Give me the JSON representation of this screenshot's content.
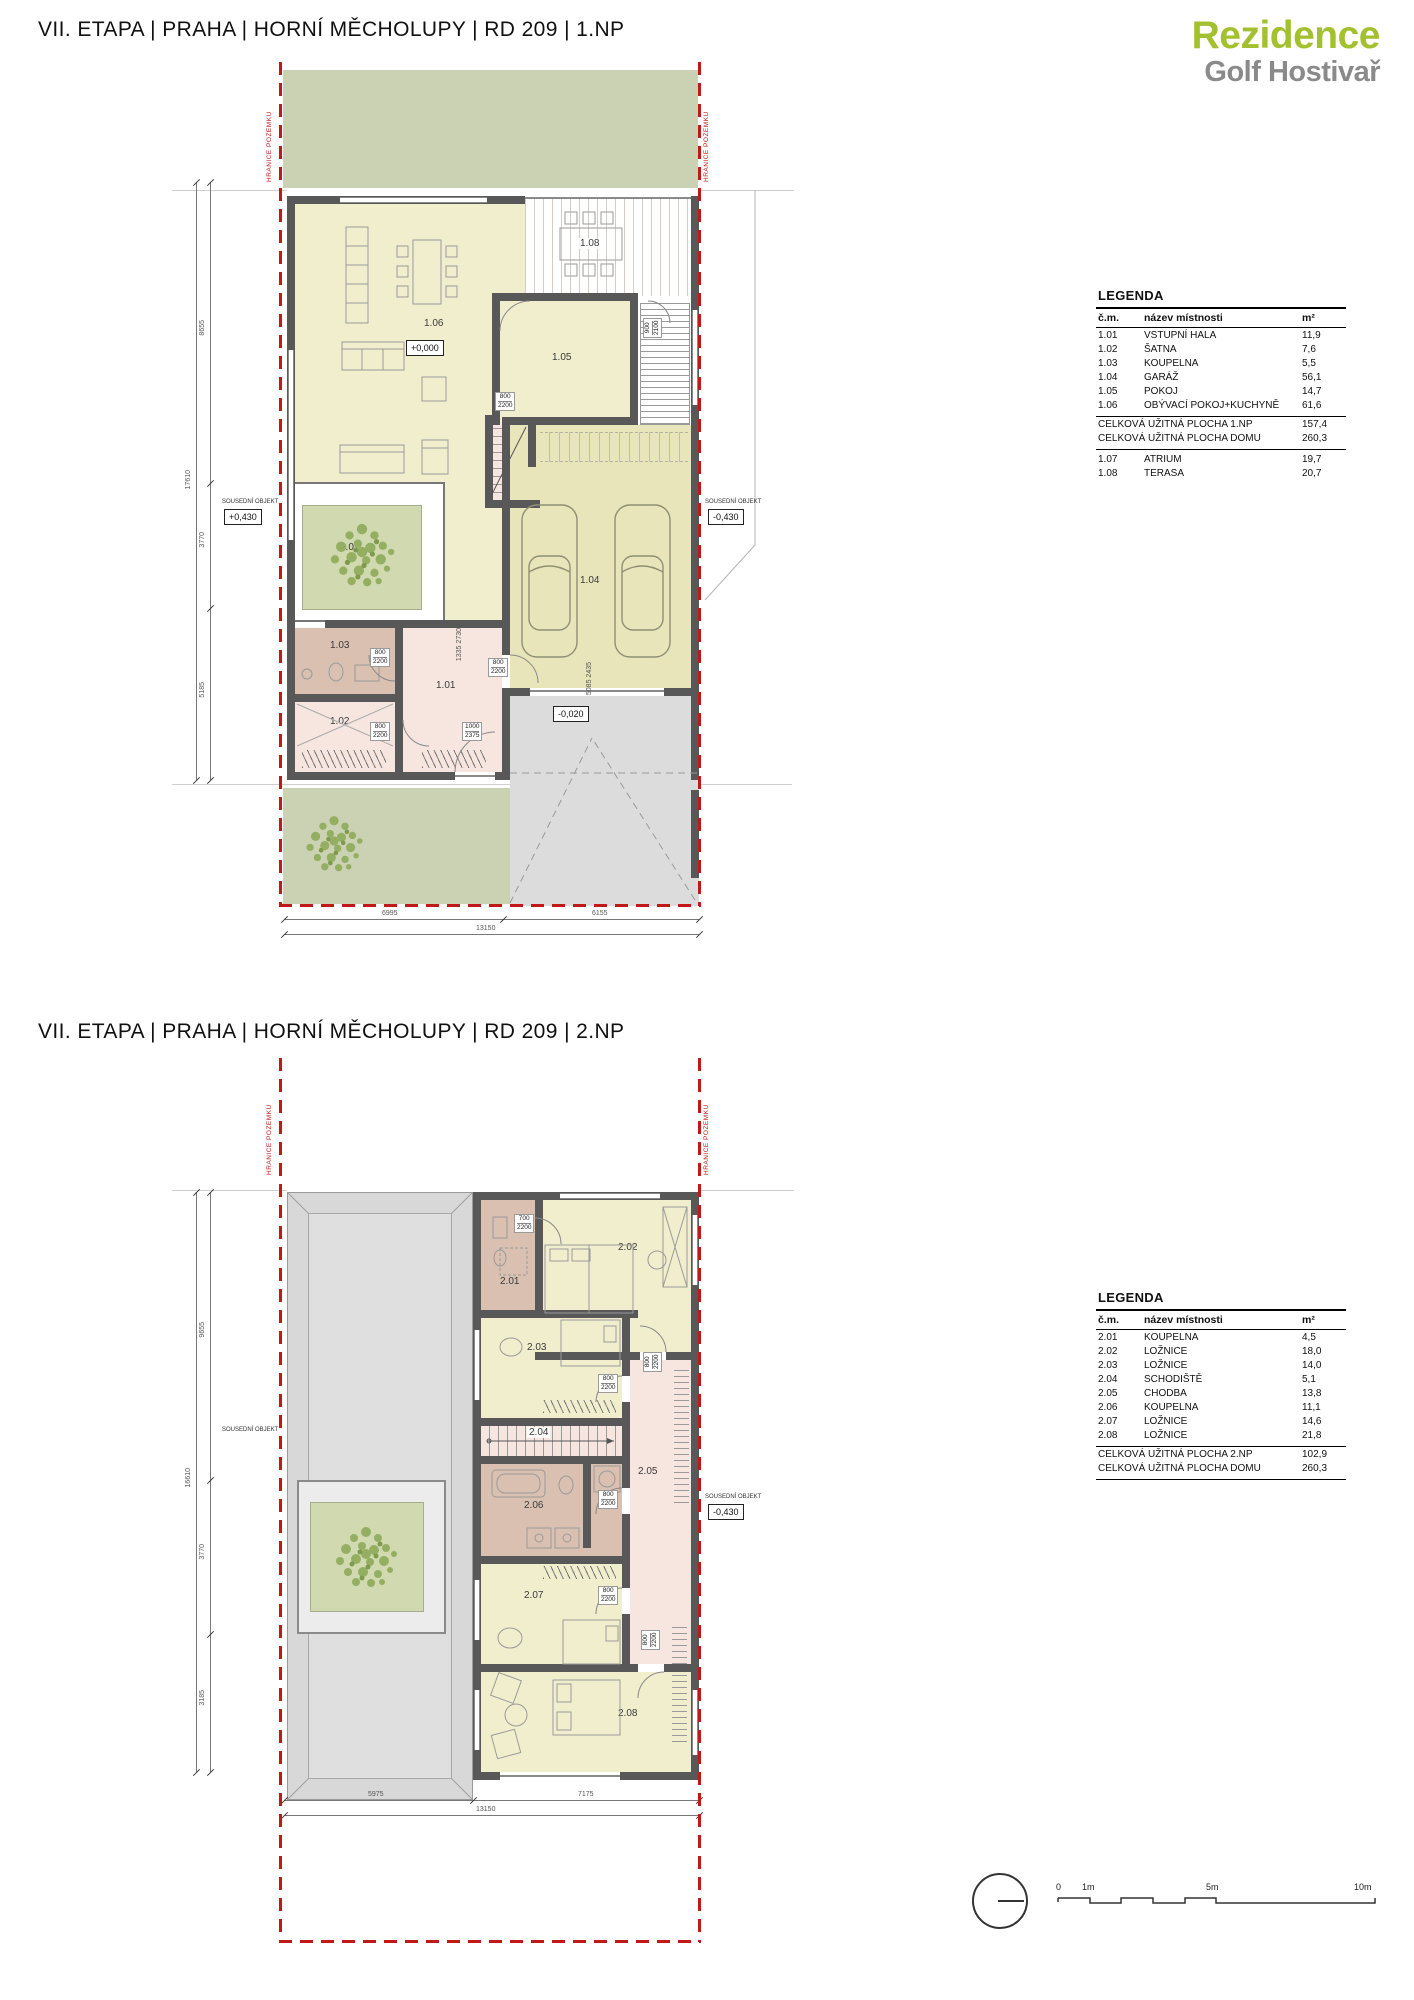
{
  "titles": {
    "plan1": "VII. ETAPA  |  PRAHA  | HORNÍ MĚCHOLUPY | RD 209  |  1.NP",
    "plan2": "VII. ETAPA  |  PRAHA  | HORNÍ MĚCHOLUPY | RD 209  |  2.NP"
  },
  "logo": {
    "line1": "Rezidence",
    "line2": "Golf Hostivař",
    "green": "#a3c12e",
    "gray": "#8a8a8a"
  },
  "legend1": {
    "heading": "LEGENDA",
    "col_num": "č.m.",
    "col_name": "název místnosti",
    "col_area": "m²",
    "rows": [
      {
        "num": "1.01",
        "name": "VSTUPNÍ HALA",
        "area": "11,9"
      },
      {
        "num": "1.02",
        "name": "ŠATNA",
        "area": "7,6"
      },
      {
        "num": "1.03",
        "name": "KOUPELNA",
        "area": "5,5"
      },
      {
        "num": "1.04",
        "name": "GARÁŽ",
        "area": "56,1"
      },
      {
        "num": "1.05",
        "name": "POKOJ",
        "area": "14,7"
      },
      {
        "num": "1.06",
        "name": "OBÝVACÍ POKOJ+KUCHYNĚ",
        "area": "61,6"
      }
    ],
    "totals": [
      {
        "name": "CELKOVÁ UŽITNÁ PLOCHA 1.NP",
        "area": "157,4"
      },
      {
        "name": "CELKOVÁ UŽITNÁ PLOCHA DOMU",
        "area": "260,3"
      }
    ],
    "extra": [
      {
        "num": "1.07",
        "name": "ATRIUM",
        "area": "19,7"
      },
      {
        "num": "1.08",
        "name": "TERASA",
        "area": "20,7"
      }
    ]
  },
  "legend2": {
    "heading": "LEGENDA",
    "col_num": "č.m.",
    "col_name": "název místnosti",
    "col_area": "m²",
    "rows": [
      {
        "num": "2.01",
        "name": "KOUPELNA",
        "area": "4,5"
      },
      {
        "num": "2.02",
        "name": "LOŽNICE",
        "area": "18,0"
      },
      {
        "num": "2.03",
        "name": "LOŽNICE",
        "area": "14,0"
      },
      {
        "num": "2.04",
        "name": "SCHODIŠTĚ",
        "area": "5,1"
      },
      {
        "num": "2.05",
        "name": "CHODBA",
        "area": "13,8"
      },
      {
        "num": "2.06",
        "name": "KOUPELNA",
        "area": "11,1"
      },
      {
        "num": "2.07",
        "name": "LOŽNICE",
        "area": "14,6"
      },
      {
        "num": "2.08",
        "name": "LOŽNICE",
        "area": "21,8"
      }
    ],
    "totals": [
      {
        "name": "CELKOVÁ UŽITNÁ PLOCHA 2.NP",
        "area": "102,9"
      },
      {
        "name": "CELKOVÁ UŽITNÁ PLOCHA DOMU",
        "area": "260,3"
      }
    ]
  },
  "plan1": {
    "boundary_label": "HRANICE POZEMKU",
    "neighbor_label": "SOUSEDNÍ OBJEKT",
    "rooms": {
      "r101": "1.01",
      "r102": "1.02",
      "r103": "1.03",
      "r104": "1.04",
      "r105": "1.05",
      "r106": "1.06",
      "r107": "1.07",
      "r108": "1.08"
    },
    "levels": {
      "zero": "+0,000",
      "entry": "-0,020",
      "left": "+0,430",
      "right": "-0,430"
    },
    "doors": {
      "pokoj_top": {
        "w": "900",
        "h": "2100"
      },
      "pokoj": {
        "w": "800",
        "h": "2200"
      },
      "koupelna": {
        "w": "800",
        "h": "2200"
      },
      "satna": {
        "w": "800",
        "h": "2200"
      },
      "entry": {
        "w": "1000",
        "h": "2375"
      },
      "garaz_hala": {
        "w": "800",
        "h": "2200"
      },
      "stair_dim": {
        "w": "1335",
        "h": "2730"
      },
      "garage_door": {
        "w": "5085",
        "h": "2435"
      }
    },
    "dims": {
      "v1": "8655",
      "v2": "3770",
      "v3": "5185",
      "v_total": "17610",
      "b1": "6995",
      "b2": "6155",
      "b_total": "13150"
    }
  },
  "plan2": {
    "boundary_label": "HRANICE POZEMKU",
    "neighbor_label": "SOUSEDNÍ OBJEKT",
    "rooms": {
      "r201": "2.01",
      "r202": "2.02",
      "r203": "2.03",
      "r204": "2.04",
      "r205": "2.05",
      "r206": "2.06",
      "r207": "2.07",
      "r208": "2.08"
    },
    "levels": {
      "right": "-0,430"
    },
    "doors": {
      "d201": {
        "w": "700",
        "h": "2200"
      },
      "d202": {
        "w": "800",
        "h": "2200"
      },
      "d203": {
        "w": "800",
        "h": "2200"
      },
      "d206": {
        "w": "800",
        "h": "2200"
      },
      "d207": {
        "w": "800",
        "h": "2200"
      },
      "d208": {
        "w": "800",
        "h": "2200"
      }
    },
    "dims": {
      "v1": "9655",
      "v2": "3770",
      "v3": "3185",
      "v_total": "16610",
      "b1": "5975",
      "b2": "7175",
      "b_total": "13150"
    }
  },
  "scalebar": {
    "t0": "0",
    "t1": "1m",
    "t5": "5m",
    "t10": "10m"
  }
}
